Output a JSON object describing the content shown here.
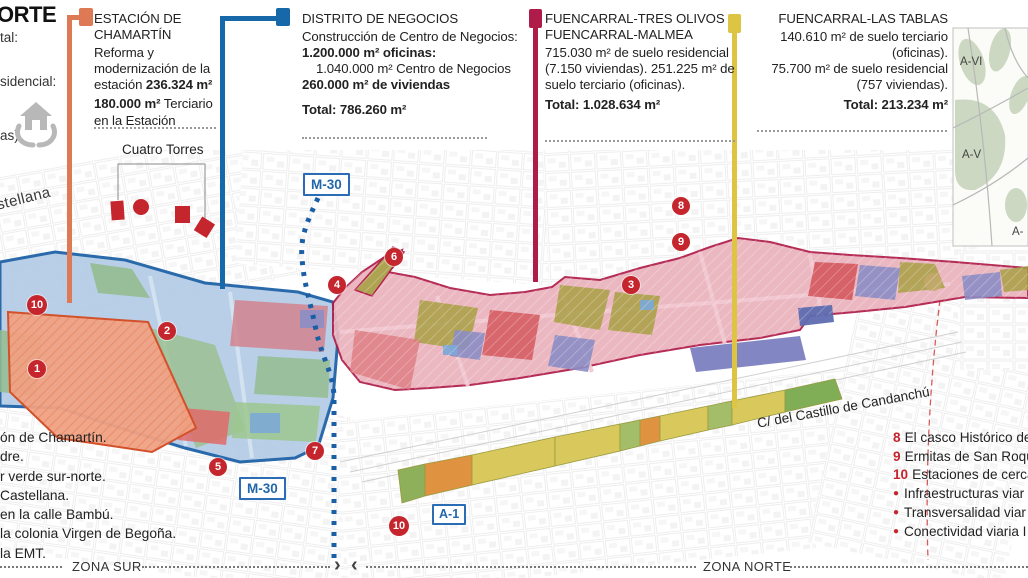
{
  "header": {
    "title_fragment": "ORTE",
    "fragment_total": "tal:",
    "fragment_residencial": "sidencial:",
    "fragment_viviendas": "as)"
  },
  "callouts": {
    "chamartin": {
      "accent_color": "#dd7a55",
      "title": "ESTACIÓN DE CHAMARTÍN",
      "p1_regular": "Reforma y modernización de la estación ",
      "p1_bold": "236.324 m²",
      "p2_bold": "180.000 m²",
      "p2_regular": " Terciario en la Estación"
    },
    "negocios": {
      "accent_color": "#1668a8",
      "title": "DISTRITO DE NEGOCIOS",
      "line1": "Construcción de Centro de Negocios:",
      "line2_bold": "1.200.000 m² oficinas:",
      "line3": "1.040.000 m² Centro de Negocios",
      "line4_bold": "260.000 m² de viviendas",
      "total": "Total: 786.260 m²"
    },
    "tres_olivos": {
      "accent_color": "#b01c4a",
      "title_line1": "FUENCARRAL-TRES OLIVOS",
      "title_line2": "FUENCARRAL-MALMEA",
      "body": "715.030 m² de suelo residencial (7.150 viviendas). 251.225 m² de suelo terciario (oficinas).",
      "total": "Total: 1.028.634 m²"
    },
    "las_tablas": {
      "accent_color": "#ddc443",
      "title": "FUENCARRAL-LAS TABLAS",
      "line1": "140.610 m² de suelo terciario (oficinas).",
      "line2": "75.700 m² de suelo residencial (757 viviendas).",
      "total": "Total: 213.234 m²"
    }
  },
  "map": {
    "labels": {
      "castellana_fragment": "stellana",
      "cuatro_torres": "Cuatro Torres",
      "m30_upper": "M-30",
      "m30_lower": "M-30",
      "a1": "A-1",
      "candanchu": "C/ del Castillo de Candanchú"
    },
    "markers": [
      {
        "n": "1"
      },
      {
        "n": "2"
      },
      {
        "n": "3"
      },
      {
        "n": "4"
      },
      {
        "n": "5"
      },
      {
        "n": "6"
      },
      {
        "n": "7"
      },
      {
        "n": "8"
      },
      {
        "n": "9"
      },
      {
        "n": "10"
      },
      {
        "n": "10"
      }
    ]
  },
  "minimap": {
    "labels": [
      "A-VI",
      "A-V",
      "A-"
    ]
  },
  "legend_left": {
    "fragments": [
      "ón de Chamartín.",
      "dre.",
      "r verde sur-norte.",
      "Castellana.",
      "en la calle Bambú.",
      "la colonia Virgen de Begoña.",
      "la EMT."
    ]
  },
  "legend_right": {
    "items": [
      {
        "marker": "8",
        "text": "El casco Histórico de"
      },
      {
        "marker": "9",
        "text": "Ermitas de San Roqu"
      },
      {
        "marker": "10",
        "text": "Estaciones de cercan"
      },
      {
        "marker": "●",
        "text": "Infraestructuras viar"
      },
      {
        "marker": "●",
        "text": "Transversalidad viar"
      },
      {
        "marker": "●",
        "text": "Conectividad viaria I"
      }
    ]
  },
  "footer": {
    "zona_sur": "ZONA SUR",
    "zona_norte": "ZONA NORTE",
    "arrow_right": "›",
    "arrow_left": "‹"
  },
  "colors": {
    "marker_red": "#c5252d",
    "zone_blue_fill": "#b3cce6",
    "zone_blue_border": "#1a5fa5",
    "zone_salmon_fill": "#f0a183",
    "zone_salmon_border": "#d2512b",
    "zone_pink_fill": "#eab3bd",
    "zone_pink_border": "#b01c4a",
    "strip_yellow": "#d9c85c",
    "strip_green": "#9ab85e",
    "strip_orange": "#df9240",
    "m30_blue": "#2167ac",
    "leader_orange": "#dd7a55",
    "leader_blue": "#1668a8",
    "leader_maroon": "#b01c4a",
    "leader_yellow": "#ddc443"
  }
}
